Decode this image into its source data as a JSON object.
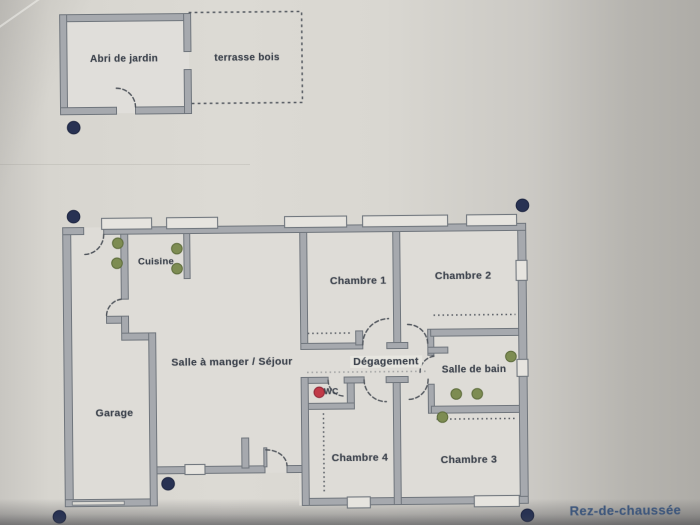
{
  "floor_label": {
    "text": "Rez-de-chaussée",
    "x": 623,
    "y": 513
  },
  "rooms": [
    {
      "id": "abri-de-jardin",
      "text": "Abri de jardin",
      "x": 126,
      "y": 57,
      "size": 10
    },
    {
      "id": "terrasse-bois",
      "text": "terrasse bois",
      "x": 249,
      "y": 57,
      "size": 10
    },
    {
      "id": "cuisine",
      "text": "Cuisine",
      "x": 156,
      "y": 260,
      "size": 9.5
    },
    {
      "id": "chambre-1",
      "text": "Chambre 1",
      "x": 358,
      "y": 281,
      "size": 10.5
    },
    {
      "id": "chambre-2",
      "text": "Chambre 2",
      "x": 463,
      "y": 277,
      "size": 10.5
    },
    {
      "id": "sejour",
      "text": "Salle à manger / Séjour",
      "x": 231,
      "y": 361,
      "size": 10.5
    },
    {
      "id": "degagement",
      "text": "Dégagement",
      "x": 385,
      "y": 362,
      "size": 10.5,
      "bg": true
    },
    {
      "id": "salle-de-bain",
      "text": "Salle de bain",
      "x": 473,
      "y": 371,
      "size": 10
    },
    {
      "id": "wc",
      "text": "WC",
      "x": 330,
      "y": 391,
      "size": 8.5
    },
    {
      "id": "garage",
      "text": "Garage",
      "x": 113,
      "y": 411,
      "size": 10.5
    },
    {
      "id": "chambre-4",
      "text": "Chambre 4",
      "x": 358,
      "y": 458,
      "size": 10.5
    },
    {
      "id": "chambre-3",
      "text": "Chambre 3",
      "x": 467,
      "y": 461,
      "size": 10.5
    }
  ],
  "markers": {
    "colors": {
      "navy": "#283253",
      "green": "#7d8c52",
      "green_edge": "#5e6d3c",
      "red": "#c13a48",
      "red_edge": "#8e2636"
    },
    "navy": [
      [
        75,
        125
      ],
      [
        74,
        214
      ],
      [
        523,
        207
      ],
      [
        166,
        482
      ],
      [
        57,
        514
      ],
      [
        525,
        517
      ]
    ],
    "green": [
      [
        118,
        241
      ],
      [
        117,
        261
      ],
      [
        177,
        247
      ],
      [
        177,
        267
      ],
      [
        510,
        358
      ],
      [
        455,
        395
      ],
      [
        476,
        395
      ],
      [
        441,
        418
      ]
    ],
    "red": [
      [
        318,
        392
      ]
    ]
  }
}
